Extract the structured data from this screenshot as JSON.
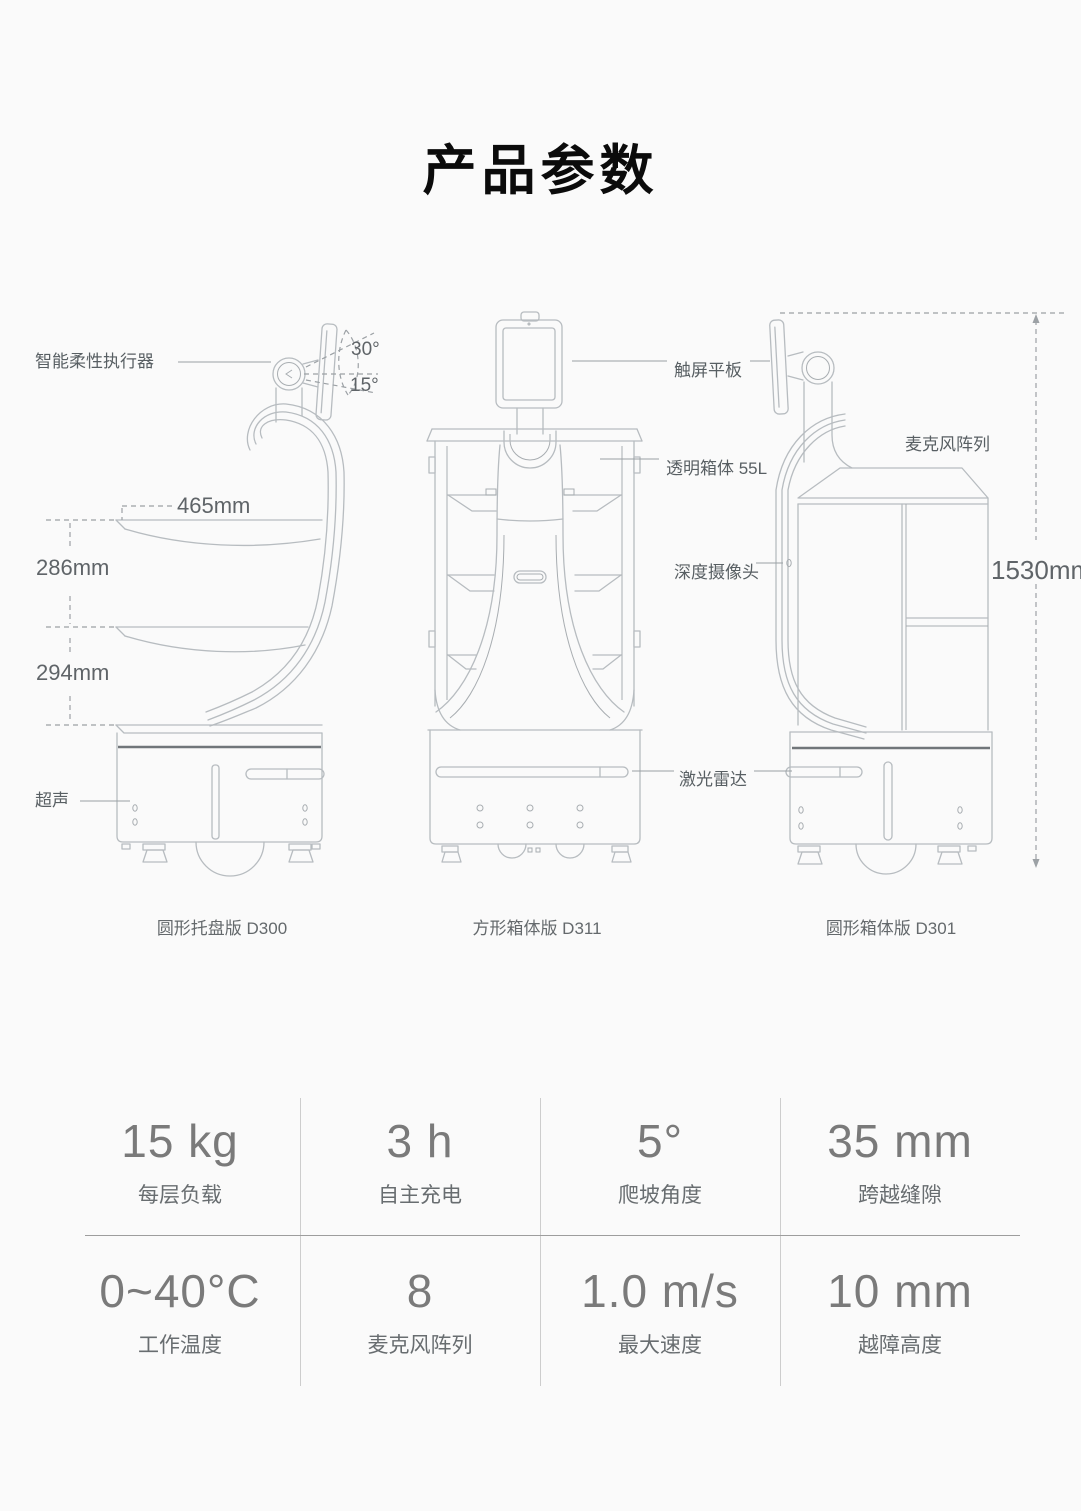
{
  "page": {
    "title": "产品参数"
  },
  "diagram": {
    "labels": {
      "actuator": "智能柔性执行器",
      "angle_up": "30°",
      "angle_down": "15°",
      "tray_width": "465mm",
      "tray_gap_top": "286mm",
      "tray_gap_bottom": "294mm",
      "ultrasonic": "超声",
      "touchscreen": "触屏平板",
      "transparent_box": "透明箱体 55L",
      "depth_camera": "深度摄像头",
      "lidar": "激光雷达",
      "mic_array": "麦克风阵列",
      "total_height": "1530mm"
    },
    "captions": [
      {
        "label": "圆形托盘版 D300"
      },
      {
        "label": "方形箱体版 D311"
      },
      {
        "label": "圆形箱体版 D301"
      }
    ]
  },
  "specs": {
    "rows": [
      [
        {
          "value": "15 kg",
          "label": "每层负载"
        },
        {
          "value": "3 h",
          "label": "自主充电"
        },
        {
          "value": "5°",
          "label": "爬坡角度"
        },
        {
          "value": "35 mm",
          "label": "跨越缝隙"
        }
      ],
      [
        {
          "value": "0~40°C",
          "label": "工作温度"
        },
        {
          "value": "8",
          "label": "麦克风阵列"
        },
        {
          "value": "1.0 m/s",
          "label": "最大速度"
        },
        {
          "value": "10 mm",
          "label": "越障高度"
        }
      ]
    ]
  },
  "colors": {
    "background": "#fafafa",
    "line": "#b7bcc0",
    "dark_line": "#71767a",
    "dashed_line": "#9ca1a5",
    "label_text": "#585f63",
    "title_text": "#0b0b0b",
    "spec_value": "#7a7a7a",
    "spec_label": "#686d70"
  }
}
